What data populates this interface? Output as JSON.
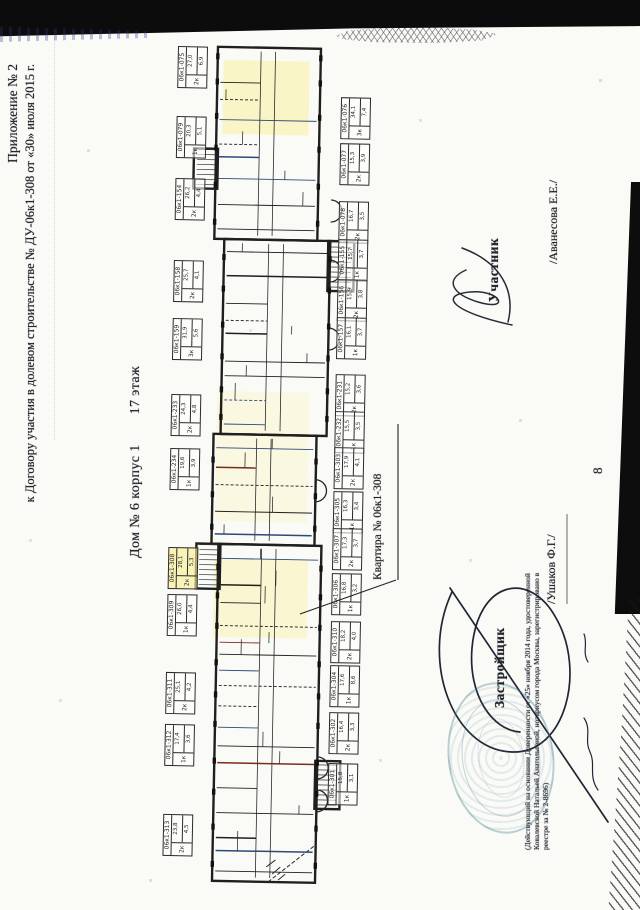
{
  "page": {
    "header_line1": "Приложение № 2",
    "header_line2": "к Договору участия в долевом строительстве № ДУ-06к1-308 от «30» июля 2015 г.",
    "page_number": "8"
  },
  "plan": {
    "title_house": "Дом № 6 корпус 1",
    "title_floor": "17 этаж",
    "apartment_callout": "Квартира № 06к1-308",
    "highlighted_unit": "06к1-308",
    "units": [
      {
        "id": "06к1-075",
        "x": 800,
        "side": "top",
        "rooms": "2к",
        "a1": "27,0",
        "a2": "6,9"
      },
      {
        "id": "06к1-079",
        "x": 730,
        "side": "top",
        "rooms": "1к",
        "a1": "20,3",
        "a2": "5,1"
      },
      {
        "id": "06к1-154",
        "x": 668,
        "side": "top",
        "rooms": "2к",
        "a1": "26,2",
        "a2": "4,4"
      },
      {
        "id": "06к1-158",
        "x": 586,
        "side": "top",
        "rooms": "2к",
        "a1": "25,7",
        "a2": "4,1"
      },
      {
        "id": "06к1-159",
        "x": 528,
        "side": "top",
        "rooms": "3к",
        "a1": "31,9",
        "a2": "5,6"
      },
      {
        "id": "06к1-233",
        "x": 452,
        "side": "top",
        "rooms": "2к",
        "a1": "24,3",
        "a2": "4,8"
      },
      {
        "id": "06к1-234",
        "x": 398,
        "side": "top",
        "rooms": "1к",
        "a1": "19,6",
        "a2": "3,9"
      },
      {
        "id": "06к1-308",
        "x": 299,
        "side": "top",
        "rooms": "2к",
        "a1": "28,1",
        "a2": "5,3"
      },
      {
        "id": "06к1-309",
        "x": 252,
        "side": "top",
        "rooms": "1к",
        "a1": "26,0",
        "a2": "4,4"
      },
      {
        "id": "06к1-311",
        "x": 174,
        "side": "top",
        "rooms": "2к",
        "a1": "25,1",
        "a2": "4,2"
      },
      {
        "id": "06к1-312",
        "x": 122,
        "side": "top",
        "rooms": "1к",
        "a1": "17,4",
        "a2": "3,6"
      },
      {
        "id": "06к1-313",
        "x": 32,
        "side": "top",
        "rooms": "2к",
        "a1": "23,8",
        "a2": "4,5"
      },
      {
        "id": "06к1-076",
        "x": 752,
        "side": "bottom",
        "rooms": "3к",
        "a1": "34,1",
        "a2": "7,4"
      },
      {
        "id": "06к1-077",
        "x": 706,
        "side": "bottom",
        "rooms": "2к",
        "a1": "15,3",
        "a2": "3,9"
      },
      {
        "id": "06к1-078",
        "x": 648,
        "side": "bottom",
        "rooms": "2к",
        "a1": "16,7",
        "a2": "3,5"
      },
      {
        "id": "06к1-155",
        "x": 610,
        "side": "bottom",
        "rooms": "1к",
        "a1": "15,7",
        "a2": "3,7"
      },
      {
        "id": "06к1-156",
        "x": 570,
        "side": "bottom",
        "rooms": "2к",
        "a1": "15,9",
        "a2": "3,8"
      },
      {
        "id": "06к1-157",
        "x": 532,
        "side": "bottom",
        "rooms": "1к",
        "a1": "16,1",
        "a2": "3,7"
      },
      {
        "id": "06к1-231",
        "x": 475,
        "side": "bottom",
        "rooms": "2к",
        "a1": "15,2",
        "a2": "3,6"
      },
      {
        "id": "06к1-232",
        "x": 438,
        "side": "bottom",
        "rooms": "1к",
        "a1": "15,5",
        "a2": "3,5"
      },
      {
        "id": "06к1-303",
        "x": 402,
        "side": "bottom",
        "rooms": "2к",
        "a1": "17,9",
        "a2": "4,1"
      },
      {
        "id": "06к1-305",
        "x": 358,
        "side": "bottom",
        "rooms": "1к",
        "a1": "16,3",
        "a2": "3,4"
      },
      {
        "id": "06к1-307",
        "x": 321,
        "side": "bottom",
        "rooms": "2к",
        "a1": "17,3",
        "a2": "3,7"
      },
      {
        "id": "06к1-306",
        "x": 276,
        "side": "bottom",
        "rooms": "1к",
        "a1": "16,8",
        "a2": "3,2"
      },
      {
        "id": "06к1-310",
        "x": 228,
        "side": "bottom",
        "rooms": "2к",
        "a1": "18,2",
        "a2": "4,0"
      },
      {
        "id": "06к1-304",
        "x": 184,
        "side": "bottom",
        "rooms": "1к",
        "a1": "17,6",
        "a2": "8,6"
      },
      {
        "id": "06к1-302",
        "x": 137,
        "side": "bottom",
        "rooms": "2к",
        "a1": "16,4",
        "a2": "3,3"
      },
      {
        "id": "06к1-301",
        "x": 86,
        "side": "bottom",
        "rooms": "1к",
        "a1": "15,8",
        "a2": "3,1"
      }
    ]
  },
  "signatures": {
    "participant": {
      "role": "Участник",
      "name": "/Аванесова Е.Е./"
    },
    "developer": {
      "role": "Застройщик",
      "name": "/Ушаков Ф.Г./",
      "note": "(Действующий на основании Доверенности от «25» ноября 2014 года, удостоверенной Ковалевской Натальей Анатольевной, нотариусом города Москвы, зарегистрировано в реестре за № 2-8696)"
    }
  },
  "colors": {
    "ink": "#23252b",
    "plan_wall": "#1f1f1f",
    "accent_red": "#7a2b1f",
    "accent_blue": "#2c4a78",
    "highlight_yellow": "#faf096",
    "stamp_teal": "#3e7d8a",
    "scan_band": "#0d0d0d"
  }
}
